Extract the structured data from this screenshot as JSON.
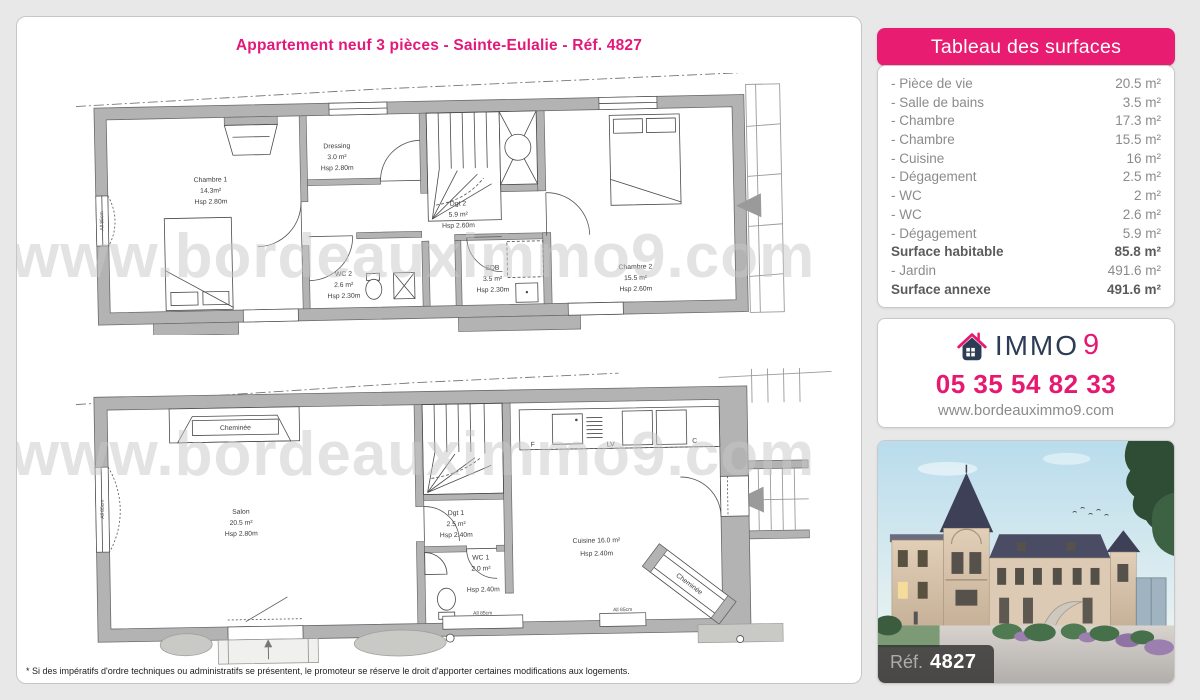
{
  "page": {
    "title": "Appartement neuf 3 pièces - Sainte-Eulalie - Réf. 4827",
    "watermark": "www.bordeauximmo9.com",
    "disclaimer": "* Si des impératifs d'ordre techniques ou administratifs se présentent, le promoteur se réserve le droit d'apporter certaines modifications aux logements."
  },
  "surfaces": {
    "header": "Tableau des surfaces",
    "rows": [
      {
        "label": "- Pièce de vie",
        "value": "20.5 m²"
      },
      {
        "label": "- Salle de bains",
        "value": "3.5 m²"
      },
      {
        "label": "- Chambre",
        "value": "17.3 m²"
      },
      {
        "label": "- Chambre",
        "value": "15.5 m²"
      },
      {
        "label": "- Cuisine",
        "value": "16 m²"
      },
      {
        "label": "- Dégagement",
        "value": "2.5 m²"
      },
      {
        "label": "- WC",
        "value": "2 m²"
      },
      {
        "label": "- WC",
        "value": "2.6 m²"
      },
      {
        "label": "- Dégagement",
        "value": "5.9 m²"
      },
      {
        "label": "Surface habitable",
        "value": "85.8 m²"
      },
      {
        "label": "- Jardin",
        "value": "491.6 m²"
      },
      {
        "label": "Surface annexe",
        "value": "491.6 m²"
      }
    ]
  },
  "agency": {
    "brand_immo": "IMMO",
    "brand_9": "9",
    "phone": "05 35 54 82 33",
    "website": "www.bordeauximmo9.com"
  },
  "photo": {
    "ref_label": "Réf.",
    "ref_number": "4827"
  },
  "plans": {
    "upper": {
      "chambre1": {
        "name": "Chambre 1",
        "area": "14.3m²",
        "hsp": "Hsp 2.80m"
      },
      "dressing": {
        "name": "Dressing",
        "area": "3.0 m²",
        "hsp": "Hsp 2.80m"
      },
      "wc2": {
        "name": "WC 2",
        "area": "2.6 m²",
        "hsp": "Hsp 2.30m"
      },
      "dgt2": {
        "name": "Dgt 2",
        "area": "5.9 m²",
        "hsp": "Hsp 2.60m"
      },
      "sdb": {
        "name": "SDB",
        "area": "3.5 m²",
        "hsp": "Hsp 2.30m"
      },
      "chambre2": {
        "name": "Chambre 2",
        "area": "15.5 m²",
        "hsp": "Hsp 2.60m"
      },
      "window_note": "All 85cm"
    },
    "lower": {
      "cheminee": "Cheminée",
      "salon": {
        "name": "Salon",
        "area": "20.5 m²",
        "hsp": "Hsp 2.80m"
      },
      "dgt1": {
        "name": "Dgt 1",
        "area": "2.5 m²",
        "hsp": "Hsp 2.40m"
      },
      "wc1": {
        "name": "WC 1",
        "area": "2.0 m²",
        "hsp": "Hsp 2.40m"
      },
      "cuisine": {
        "name": "Cuisine 16.0 m²",
        "hsp": "Hsp 2.40m"
      },
      "cheminee_diag": "Cheminée",
      "counter": {
        "f": "F",
        "lv": "LV",
        "c": "C"
      },
      "window_note_left": "All 85cm",
      "window_note_1": "All 85cm",
      "window_note_2": "All 85cm"
    }
  },
  "colors": {
    "accent": "#e6186f",
    "navy": "#2d3c55",
    "wall": "#b3b3b3"
  }
}
